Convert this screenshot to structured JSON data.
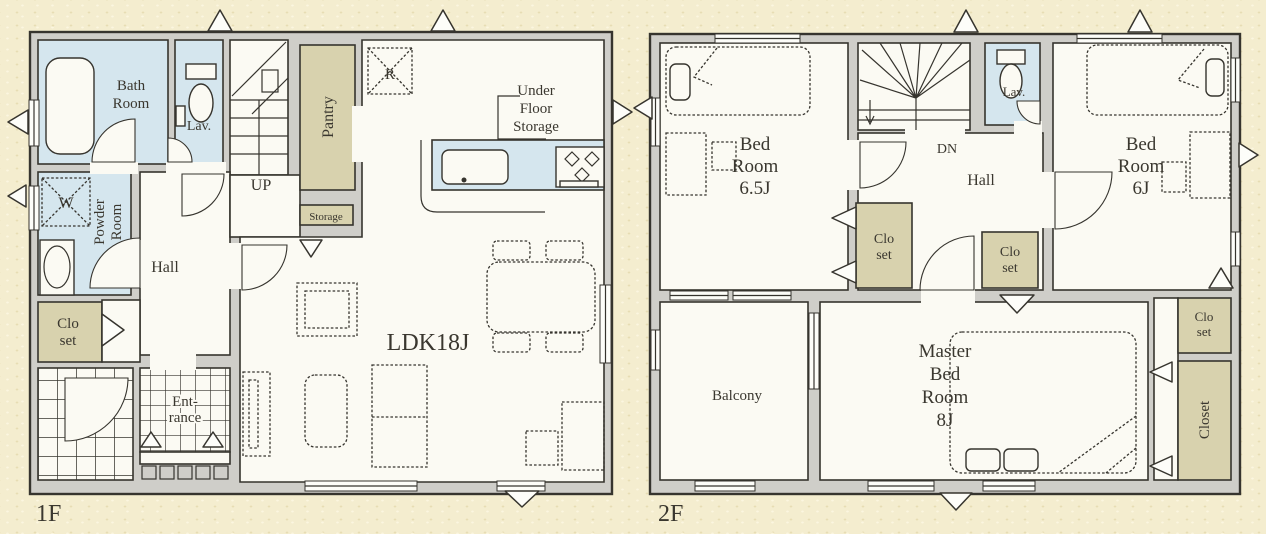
{
  "colors": {
    "wall": "#cfcec9",
    "line": "#36342e",
    "room": "#fbfaf3",
    "wet": "#d5e6ee",
    "tan": "#d8d2ae",
    "text": "#3a372f"
  },
  "floor1": {
    "label": "1F",
    "rooms": {
      "bath": "Bath\nRoom",
      "lav": "Lav.",
      "up": "UP",
      "pantry": "Pantry",
      "fridge": "R",
      "under_floor_storage": "Under\nFloor\nStorage",
      "storage": "Storage",
      "washer": "W",
      "powder": "Powder\nRoom",
      "hall": "Hall",
      "closet": "Clo\nset",
      "entrance": "Ent-\nrance",
      "ldk": "LDK18J"
    }
  },
  "floor2": {
    "label": "2F",
    "rooms": {
      "bedroom_65": "Bed\nRoom\n6.5J",
      "dn": "DN",
      "lav": "Lav.",
      "hall": "Hall",
      "bedroom_6": "Bed\nRoom\n6J",
      "closet_a": "Clo\nset",
      "closet_b": "Clo\nset",
      "closet_c": "Clo\nset",
      "closet_tall": "Closet",
      "balcony": "Balcony",
      "master": "Master\nBed\nRoom\n8J"
    }
  }
}
